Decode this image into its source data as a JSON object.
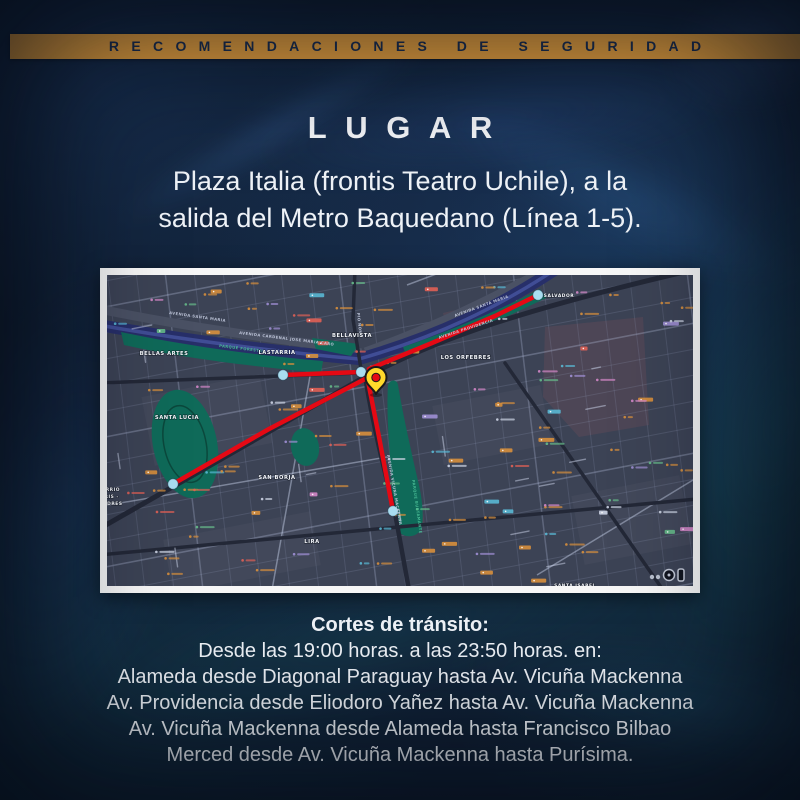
{
  "poster": {
    "banner": {
      "text": "RECOMENDACIONES DE SEGURIDAD",
      "bg": "#ECA43F",
      "fg": "#1C2F52"
    },
    "title": "LUGAR",
    "location_line1": "Plaza Italia (frontis Teatro Uchile), a la",
    "location_line2": "salida del Metro Baquedano (Línea 1-5).",
    "traffic": {
      "heading": "Cortes de tránsito:",
      "schedule": "Desde las 19:00 horas. a las 23:50 horas. en:",
      "closures": [
        "Alameda desde Diagonal Paraguay hasta Av. Vicuña Mackenna",
        "Av. Providencia desde Eliodoro Yañez hasta Av. Vicuña Mackenna",
        "Av. Vicuña Mackenna desde Alameda hasta Francisco Bilbao",
        "Merced desde Av. Vicuña Mackenna hasta Purísima."
      ]
    }
  },
  "map": {
    "colors": {
      "land": "#3C4355",
      "block": "#4F4757",
      "park": "#0F6A59",
      "river": "#272F69",
      "river_glow": "#5A73CD",
      "road_band": "#4A5164",
      "road_major": "#232837",
      "route": "#E50914",
      "endpoint": "#A9DDF0",
      "pin": "#FFD92B",
      "pin_center": "#E50914",
      "label": "#F5F7FB"
    },
    "neighborhoods": [
      {
        "label": "BELLAS ARTES",
        "x": 57,
        "y": 80
      },
      {
        "label": "LASTARRIA",
        "x": 170,
        "y": 79
      },
      {
        "label": "BELLAVISTA",
        "x": 245,
        "y": 62
      },
      {
        "label": "SANTA LUCIA",
        "x": 70,
        "y": 144
      },
      {
        "label": "SAN BORJA",
        "x": 170,
        "y": 204
      },
      {
        "label": "LIRA",
        "x": 205,
        "y": 268
      },
      {
        "label": "LOS ORFEBRES",
        "x": 359,
        "y": 84
      },
      {
        "label": "SALVADOR",
        "x": 452,
        "y": 22,
        "size": 4.4
      },
      {
        "label": "BARRIO",
        "x": 2,
        "y": 216,
        "size": 4.4
      },
      {
        "label": "PARIS -",
        "x": 1,
        "y": 223,
        "size": 4.4
      },
      {
        "label": "LONDRES",
        "x": 2,
        "y": 230,
        "size": 4.4
      },
      {
        "label": "SANTA ISABEL",
        "x": 468,
        "y": 312,
        "size": 4.4
      }
    ],
    "street_labels": [
      {
        "label": "AVENIDA SANTA MARIA",
        "x": 62,
        "y": 39,
        "angle": 8
      },
      {
        "label": "AVENIDA CARDENAL JOSE MARIA CARO",
        "x": 132,
        "y": 59,
        "angle": 7
      },
      {
        "label": "AVENIDA SANTA MARIA",
        "x": 348,
        "y": 42,
        "angle": -20
      },
      {
        "label": "AVENIDA PROVIDENCIA",
        "x": 332,
        "y": 64,
        "angle": -18
      },
      {
        "label": "AVENIDA VICUNA MACKENNA",
        "x": 280,
        "y": 180,
        "angle": 80
      },
      {
        "label": "PIO NONO",
        "x": 250,
        "y": 38,
        "angle": 84
      },
      {
        "label": "PARQUE FORESTAL",
        "x": 112,
        "y": 72,
        "angle": 7,
        "color": "#49BD96"
      },
      {
        "label": "PARQUE BUSTAMANTE",
        "x": 305,
        "y": 205,
        "angle": 82,
        "color": "#49BD96"
      }
    ],
    "routes": [
      {
        "name": "merced",
        "points": [
          [
            176,
            100
          ],
          [
            254,
            97
          ]
        ]
      },
      {
        "name": "alameda",
        "points": [
          [
            66,
            209
          ],
          [
            162,
            154
          ],
          [
            258,
            104
          ]
        ]
      },
      {
        "name": "vicuna-mackenna",
        "points": [
          [
            261,
            106
          ],
          [
            272,
            162
          ],
          [
            286,
            236
          ]
        ]
      },
      {
        "name": "providencia",
        "points": [
          [
            262,
            94
          ],
          [
            325,
            68
          ],
          [
            388,
            41
          ],
          [
            431,
            20
          ]
        ]
      }
    ],
    "endpoints": [
      [
        176,
        100
      ],
      [
        254,
        97
      ],
      [
        66,
        209
      ],
      [
        286,
        236
      ],
      [
        431,
        20
      ]
    ],
    "pin": {
      "x": 269,
      "y": 119
    },
    "attribution_icons": [
      "dots-icon",
      "compass-icon",
      "phone-icon"
    ]
  }
}
